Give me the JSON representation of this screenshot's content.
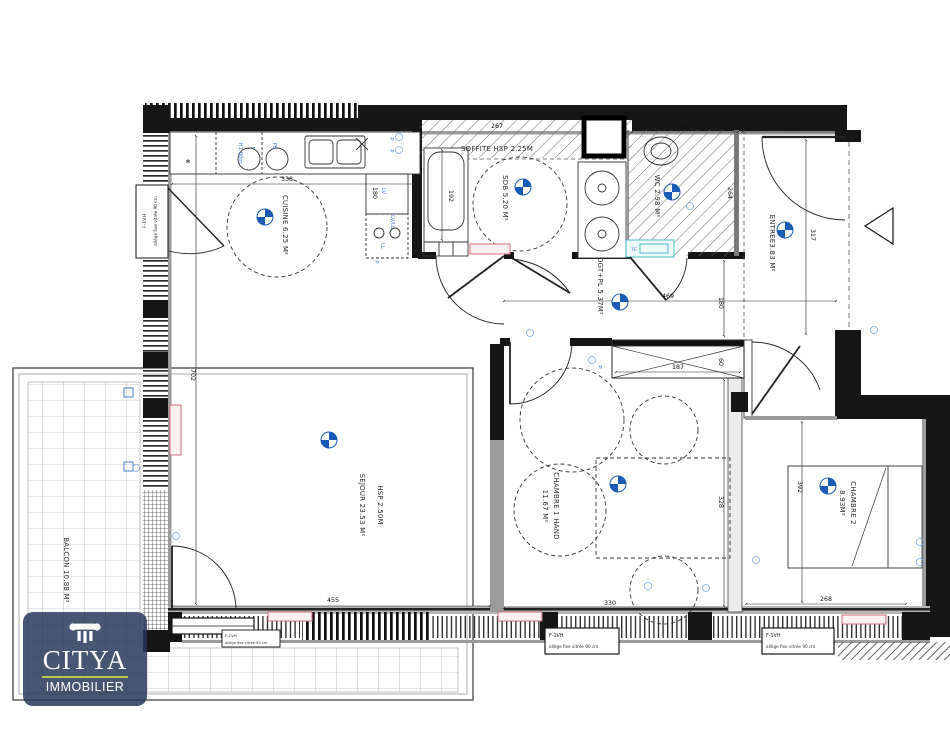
{
  "rooms": {
    "cuisine": {
      "label": "CUISINE 6.25 M²"
    },
    "sdb": {
      "label": "SDB 5.20 M²"
    },
    "wc": {
      "label": "WC 2.98 M²"
    },
    "soffite": {
      "label": "SOFFITE HSP 2.25M"
    },
    "entree": {
      "label": "ENTREE3.83 M²"
    },
    "degagement": {
      "label": "DGT+PL 5.37M²"
    },
    "sejour": {
      "label": "SEJOUR 23.53 M²",
      "height_note": "HSP 2.50M"
    },
    "chambre1": {
      "label": "CHAMBRE 1 HAND",
      "area": "11.67 M²"
    },
    "chambre2": {
      "label": "CHAMBRE 2",
      "area": "8.93M²"
    },
    "balcon": {
      "label": "BALCON 10.88 M²"
    }
  },
  "dims": {
    "cuisine_width": "338",
    "top_wall": "267",
    "bath": "192",
    "wc_top": "159",
    "entree_top": "121",
    "entree_side": "317",
    "wc_side": "264",
    "corridor": "469",
    "corridor_width": "180",
    "placard_w": "187",
    "placard_d": "60",
    "ch1_side": "328",
    "ch1_bottom": "330",
    "ch2_bottom": "268",
    "ch2_side": "392",
    "sejour_bottom": "455",
    "sejour_side": "702",
    "lv": "180"
  },
  "window_labels": {
    "type": "F-1VH",
    "desc": "allège fixe vitrée 90 cm"
  },
  "tech": {
    "lv": "LV",
    "lvll": "LV/LL",
    "ll": "LL",
    "p": "P",
    "f": "F",
    "pb": "PB",
    "hood": "H1.80m",
    "te": "TE",
    "asterisk": "*"
  },
  "logo": {
    "brand": "CITYA",
    "tagline": "IMMOBILIER",
    "bg_color": "#263658",
    "underline_color": "#b9c94a"
  },
  "colors": {
    "wall": "#161616",
    "inner_face": "#9b9b9b",
    "marker_blue": "#1a5bb5",
    "tech_blue": "#4a7ed2",
    "radiator": "#cf6f80",
    "teal": "#3bb6c4"
  }
}
